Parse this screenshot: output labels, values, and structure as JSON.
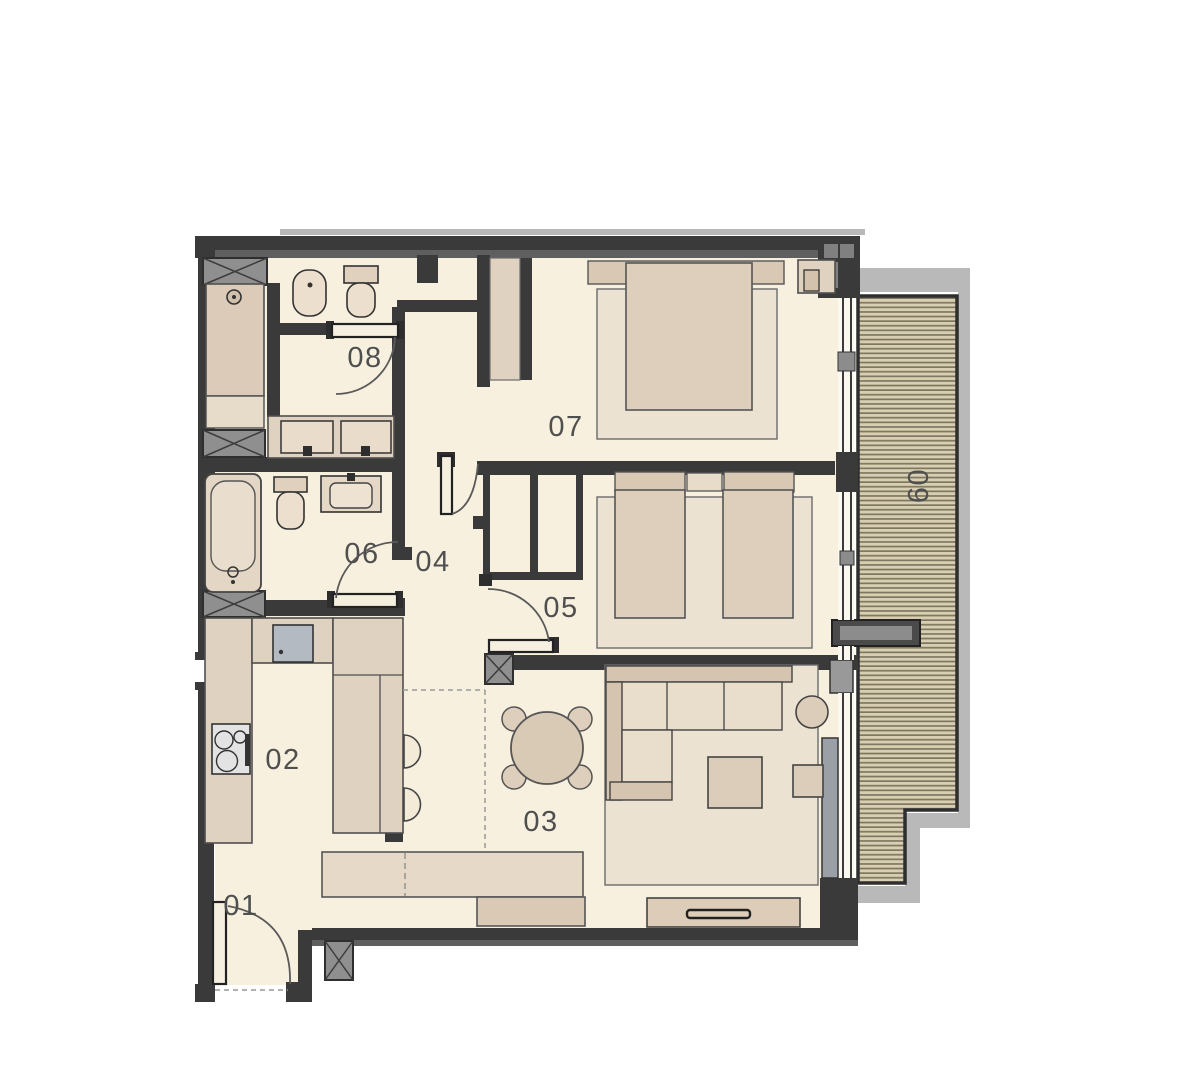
{
  "plan": {
    "type": "apartment-floor-plan",
    "rooms": [
      {
        "number": "01",
        "name": "entry-hall"
      },
      {
        "number": "02",
        "name": "kitchen"
      },
      {
        "number": "03",
        "name": "living-dining-room"
      },
      {
        "number": "04",
        "name": "hallway"
      },
      {
        "number": "05",
        "name": "bedroom-2"
      },
      {
        "number": "06",
        "name": "bathroom"
      },
      {
        "number": "07",
        "name": "bedroom-1"
      },
      {
        "number": "08",
        "name": "wc-shower-room"
      },
      {
        "number": "09",
        "name": "balcony"
      }
    ],
    "fixtures": [
      "shower",
      "bathtub",
      "toilet",
      "bidet",
      "double-washbasin-vanity",
      "washbasin",
      "kitchen-sink",
      "cooktop",
      "kitchen-island",
      "bar-stools",
      "dining-table",
      "dining-chairs",
      "corner-sofa",
      "coffee-table",
      "side-table",
      "pouf",
      "tv-console",
      "sideboard",
      "double-bed",
      "twin-beds",
      "rug",
      "wardrobe",
      "balcony-decking",
      "door-swing",
      "window"
    ],
    "colors": {
      "wall": "#3a3a3a",
      "floor": "#f7f0de",
      "furniture": "#e0d2c0",
      "furniture_light": "#ece2d2",
      "deck": "#d8cfb2",
      "deck_line": "#7e7761",
      "balcony_outline": "#b9b9b9",
      "label": "#4f4f4f",
      "background": "#ffffff"
    }
  }
}
